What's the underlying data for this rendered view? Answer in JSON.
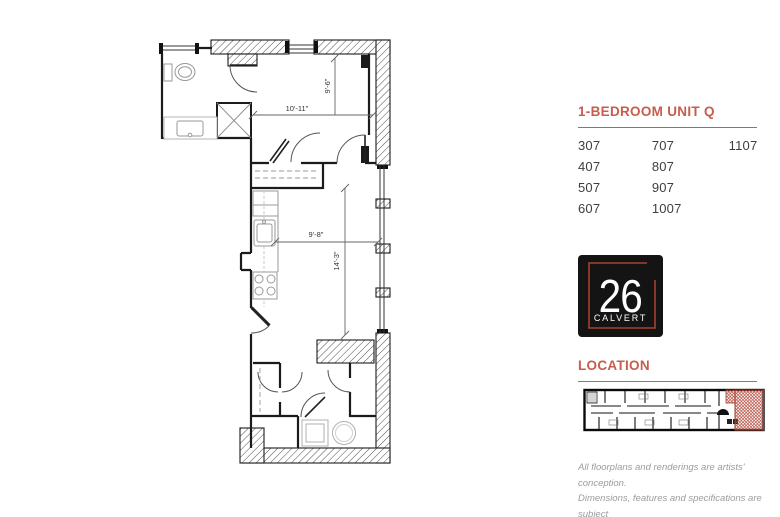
{
  "colors": {
    "accent": "#C85C4D",
    "ink": "#3E3E3E",
    "logo_bg": "#141414",
    "logo_red": "#A8402F",
    "muted_text": "#9C9C9C",
    "highlight_red": "#B5473A"
  },
  "unit": {
    "title": "1-BEDROOM UNIT Q"
  },
  "units": {
    "col1": [
      "307",
      "407",
      "507",
      "607"
    ],
    "col2": [
      "707",
      "807",
      "907",
      "1007"
    ],
    "col3": [
      "1107"
    ]
  },
  "logo": {
    "number": "26",
    "name": "CALVERT"
  },
  "location": {
    "title": "LOCATION"
  },
  "floorplan": {
    "dim_bedroom_width": "10'-11\"",
    "dim_bedroom_depth": "9'-6\"",
    "dim_living_width": "9'-8\"",
    "dim_living_depth": "14'-3\""
  },
  "disclaimer": {
    "line1": "All floorplans and renderings are artists' conception.",
    "line2": "Dimensions, features and specifications are subject",
    "line3": "to change at the discretion of the builder."
  }
}
